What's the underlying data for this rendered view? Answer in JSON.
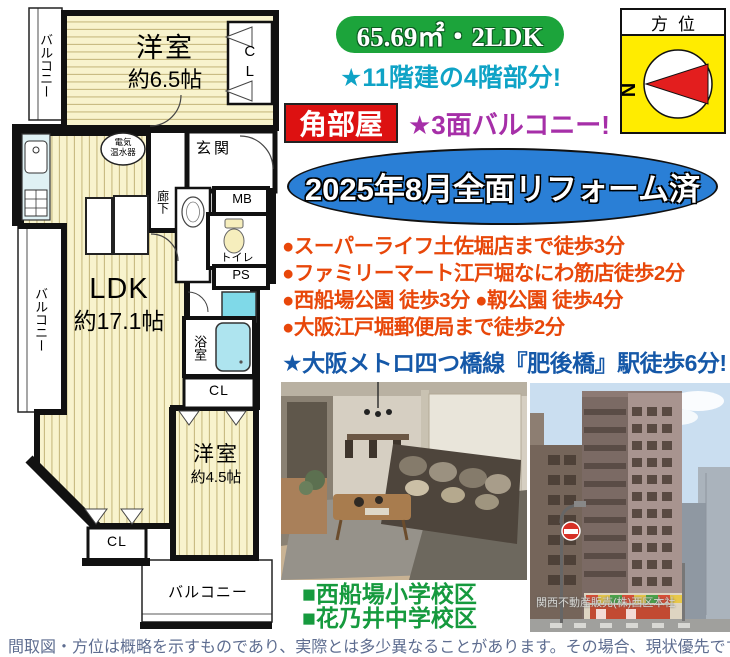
{
  "listing": {
    "area_type": "65.69㎡・2LDK",
    "floor_note": "★11階建の4階部分!",
    "corner_label": "角部屋",
    "balcony_note": "★3面バルコニー!",
    "reform_note": "2025年8月全面リフォーム済"
  },
  "compass": {
    "title": "方位",
    "north": "N"
  },
  "highlights": [
    "●スーパーライフ土佐堀店まで徒歩3分",
    "●ファミリーマート江戸堀なにわ筋店徒歩2分",
    "●西船場公園 徒歩3分 ●靱公園 徒歩4分",
    "●大阪江戸堀郵便局まで徒歩2分"
  ],
  "station_note": "★大阪メトロ四つ橋線『肥後橋』駅徒歩6分!",
  "schools": {
    "elementary": "■西船場小学校区",
    "junior_high": "■花乃井中学校区"
  },
  "photos": {
    "building_caption": "関西不動産販売(株)西区本社"
  },
  "floorplan": {
    "balcony_top": "バルコニー",
    "room1_name": "洋室",
    "room1_size": "約6.5帖",
    "cl_top": "CL",
    "heater_line1": "電気",
    "heater_line2": "温水器",
    "entrance": "玄関",
    "corridor": "廊下",
    "mb": "MB",
    "toilet": "トイレ",
    "ps": "PS",
    "bath": "浴室",
    "cl_mid": "CL",
    "ldk_name": "LDK",
    "ldk_size": "約17.1帖",
    "balcony_left": "バルコニー",
    "room2_name": "洋室",
    "room2_size": "約4.5帖",
    "cl_bottom": "CL",
    "balcony_bottom": "バルコニー"
  },
  "colors": {
    "badge_green": "#1ca43b",
    "accent_teal": "#0fa3c6",
    "corner_red": "#dd1111",
    "accent_magenta": "#a62fa8",
    "banner_blue": "#2a7fd6",
    "bullet_orange": "#e8470a",
    "station_blue": "#1558a8",
    "school_green": "#169a3e",
    "compass_yellow": "#ffec00",
    "tatami_cream": "#f8f3cd"
  },
  "footer": {
    "disclaimer": "間取図・方位は概略を示すものであり、実際とは多少異なることがあります。その場合、現状優先です。"
  }
}
